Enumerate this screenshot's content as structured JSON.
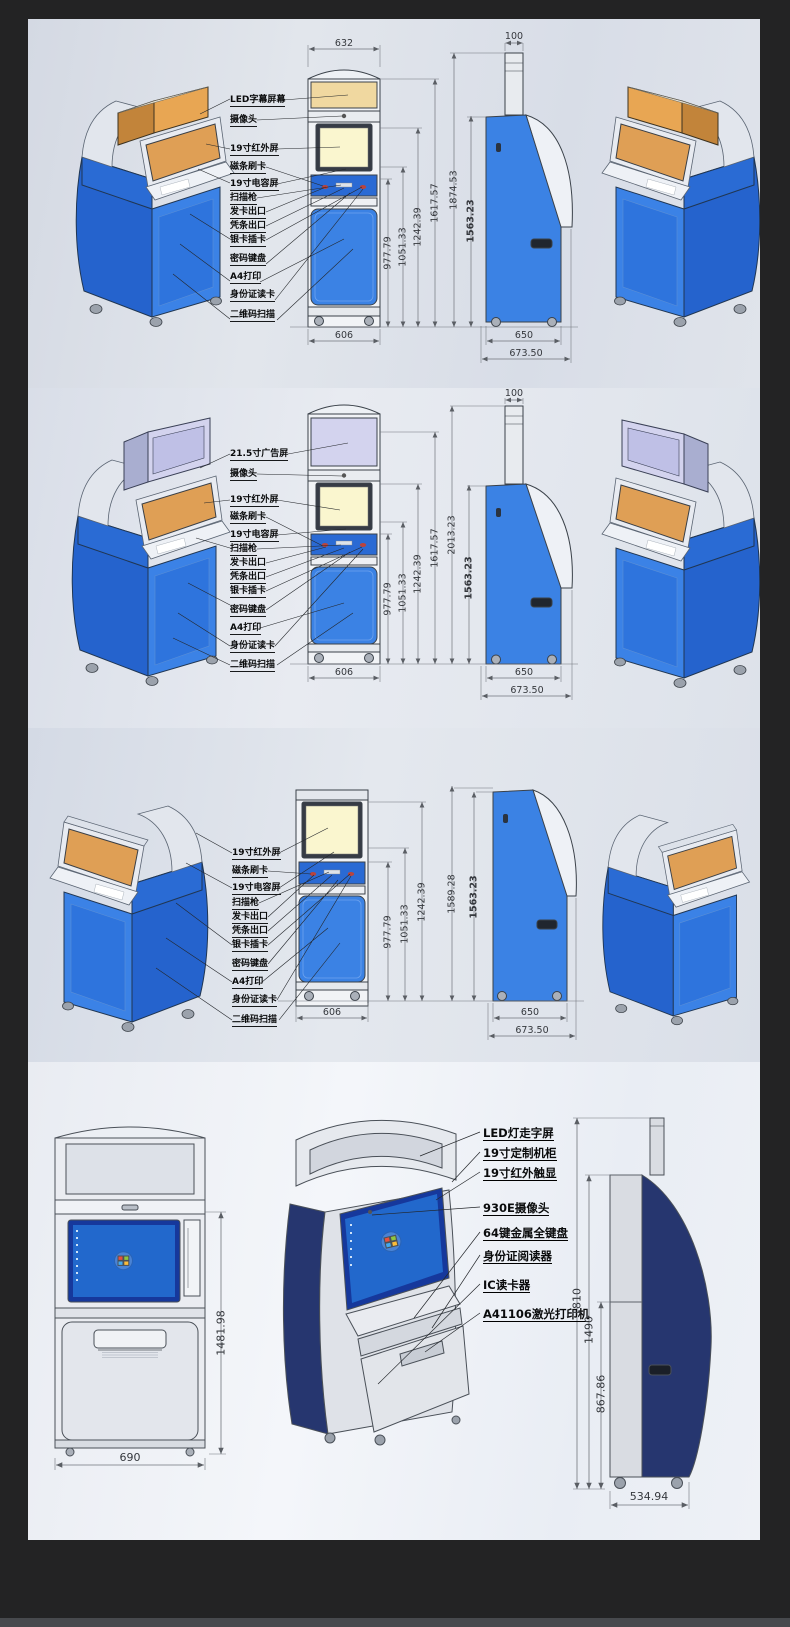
{
  "colors": {
    "kiosk_blue": "#3b82e4",
    "door_blue": "#2e74dd",
    "deep_blue": "#2465cf",
    "navy_accent": "#26366f",
    "led_band_tan": "#f0d8a0",
    "iso_led_orange": "#e8a653",
    "screen_yellow": "#faf6cf",
    "ad_screen_lavender": "#d3d3ee",
    "windows_desktop_blue": "#2268cc",
    "panel_background": "#dfe3ea",
    "page_background": "#232324"
  },
  "panels": [
    {
      "labels": [
        "LED字幕屏幕",
        "摄像头",
        "19寸红外屏",
        "磁条刷卡",
        "19寸电容屏",
        "扫描枪",
        "发卡出口",
        "凭条出口",
        "银卡插卡",
        "密码键盘",
        "A4打印",
        "身份证读卡",
        "二维码扫描"
      ],
      "dims": {
        "front_top_width": "632",
        "front_h1": "977.79",
        "front_h2": "1051.33",
        "front_h3": "1242.39",
        "front_h4": "1617.57",
        "side_total_height": "1874.53",
        "side_body_height": "1563.23",
        "pole_width": "100",
        "front_bottom_width": "606",
        "side_bottom_width": "650",
        "side_bottom_outer_width": "673.50"
      }
    },
    {
      "labels": [
        "21.5寸广告屏",
        "摄像头",
        "19寸红外屏",
        "磁条刷卡",
        "19寸电容屏",
        "扫描枪",
        "发卡出口",
        "凭条出口",
        "银卡插卡",
        "密码键盘",
        "A4打印",
        "身份证读卡",
        "二维码扫描"
      ],
      "dims": {
        "front_h1": "977.79",
        "front_h2": "1051.33",
        "front_h3": "1242.39",
        "front_h4": "1617.57",
        "side_total_height": "2013.23",
        "side_body_height": "1563.23",
        "pole_width": "100",
        "front_bottom_width": "606",
        "side_bottom_width": "650",
        "side_bottom_outer_width": "673.50"
      }
    },
    {
      "labels": [
        "19寸红外屏",
        "磁条刷卡",
        "19寸电容屏",
        "扫描枪",
        "发卡出口",
        "凭条出口",
        "银卡插卡",
        "密码键盘",
        "A4打印",
        "身份证读卡",
        "二维码扫描"
      ],
      "dims": {
        "front_h1": "977.79",
        "front_h2": "1051.33",
        "front_h3": "1242.39",
        "side_total_height": "1589.28",
        "side_body_height": "1563.23",
        "front_bottom_width": "606",
        "side_bottom_width": "650",
        "side_bottom_outer_width": "673.50"
      }
    },
    {
      "labels": [
        "LED灯走字屏",
        "19寸定制机柜",
        "19寸红外触显",
        "930E摄像头",
        "64键金属全键盘",
        "身份证阅读器",
        "IC读卡器",
        "A41106激光打印机"
      ],
      "dims": {
        "front_height": "1481.98",
        "front_bottom_width": "690",
        "side_total_height": "1810",
        "side_upper_height": "1490",
        "side_lower_height": "867.86",
        "side_bottom_width": "534.94"
      }
    }
  ]
}
